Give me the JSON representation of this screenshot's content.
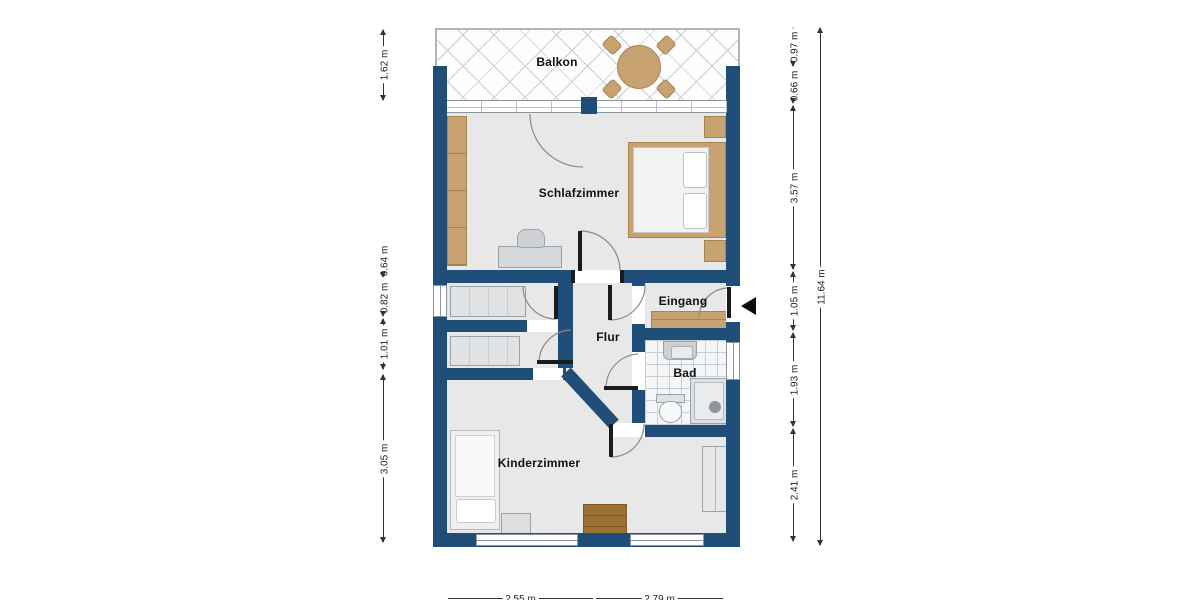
{
  "rooms": {
    "balkon": "Balkon",
    "schlafzimmer": "Schlafzimmer",
    "eingang": "Eingang",
    "flur": "Flur",
    "bad": "Bad",
    "kinderzimmer": "Kinderzimmer"
  },
  "dimensions": {
    "left": [
      "1.62 m",
      "0.64 m",
      "0.82 m",
      "1.01 m",
      "3.05 m"
    ],
    "right": [
      "0.97 m",
      "0.66 m",
      "3.57 m",
      "1.05 m",
      "1.93 m",
      "2.41 m"
    ],
    "right_total": "11.64 m",
    "bottom": [
      "2.55 m",
      "2.79 m"
    ]
  },
  "icons": {
    "entrance_marker": "entrance-arrow-left"
  },
  "colors": {
    "wall": "#1f4e79",
    "floor": "#e8e8e8",
    "wood": "#c8a271",
    "dresser": "#9c7034",
    "tile": "#c9ced3",
    "dim": "#333333",
    "text": "#111111",
    "fixture": "#dde0e3"
  }
}
